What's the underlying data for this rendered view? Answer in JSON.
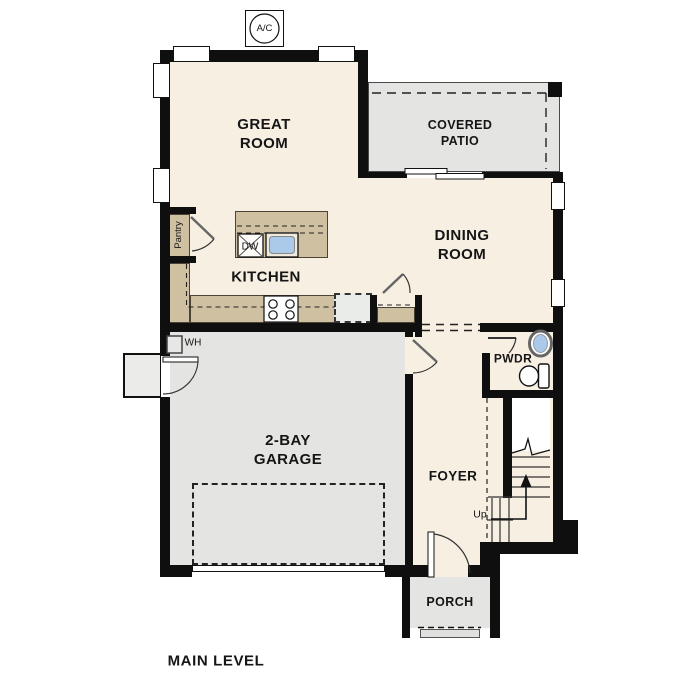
{
  "title": "MAIN LEVEL",
  "rooms": {
    "great_room": "GREAT\nROOM",
    "covered_patio": "COVERED\nPATIO",
    "dining_room": "DINING\nROOM",
    "kitchen": "KITCHEN",
    "garage": "2-BAY\nGARAGE",
    "foyer": "FOYER",
    "powder": "PWDR",
    "porch": "PORCH",
    "pantry": "Pantry"
  },
  "fixtures": {
    "ac_unit": "A/C",
    "dishwasher": "DW",
    "water_heater": "WH",
    "stairs_direction": "Up"
  },
  "colors": {
    "wall": "#0f0f0f",
    "room_cream": "#f6efe2",
    "room_gray": "#e4e4e2",
    "counter_tan": "#cfc0a2",
    "sink_blue": "#abc9e9",
    "fridge_gray": "#e9ece9"
  }
}
